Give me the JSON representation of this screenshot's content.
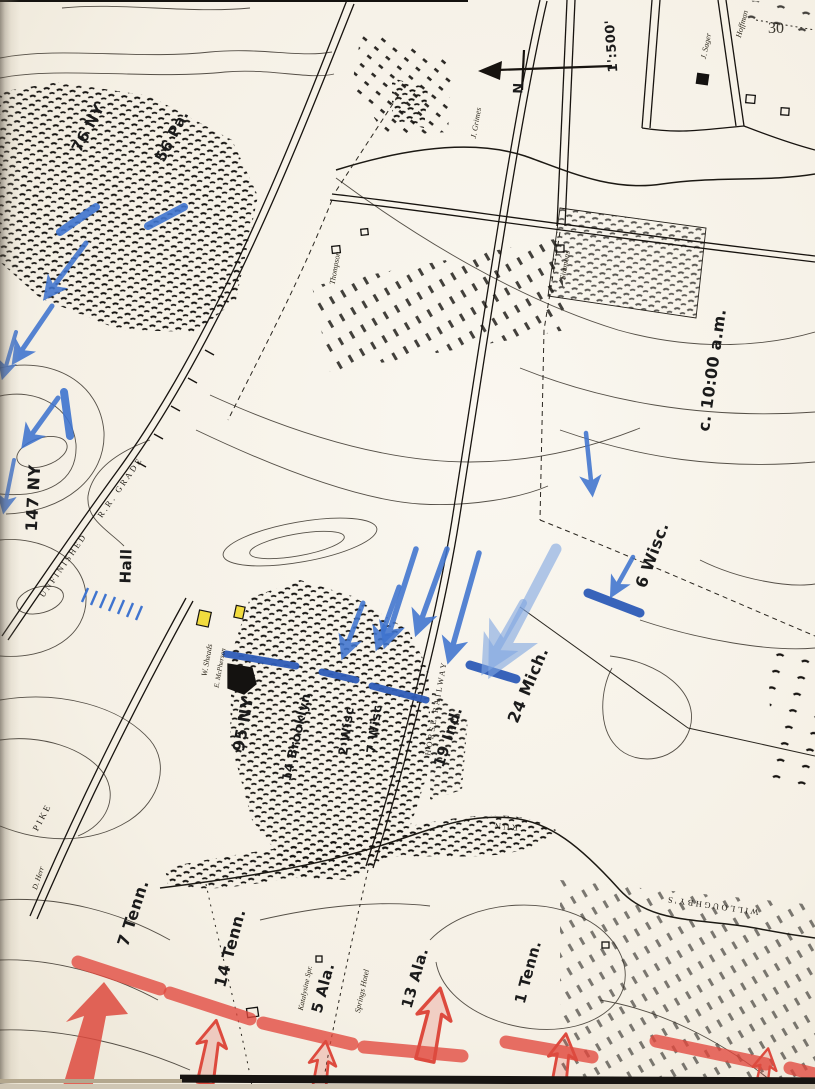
{
  "page": {
    "number": "30"
  },
  "compass": {
    "north": "N",
    "scale": "1':500'"
  },
  "notes": {
    "time": "c. 10:00 a.m."
  },
  "union_units": [
    {
      "label": "76 NY"
    },
    {
      "label": "56 Pa."
    },
    {
      "label": "147 NY"
    },
    {
      "label": "Hall"
    },
    {
      "label": "95 NY"
    },
    {
      "label": "14 Brooklyn"
    },
    {
      "label": "2 Wisc"
    },
    {
      "label": "7 Wisc"
    },
    {
      "label": "19 Ind."
    },
    {
      "label": "24 Mich."
    },
    {
      "label": "6 Wisc."
    }
  ],
  "confederate_units": [
    {
      "label": "7 Tenn."
    },
    {
      "label": "14 Tenn."
    },
    {
      "label": "5 Ala."
    },
    {
      "label": "13 Ala."
    },
    {
      "label": "1 Tenn."
    }
  ],
  "map_features": {
    "unfinished": "UNFINISHED",
    "rr_grade": "R.R. GRADE",
    "horse_railway": "HORSE RAILWAY",
    "pike": "PIKE",
    "willoughbys": "WILLOUGHBY'S",
    "run": "RUN"
  },
  "property_labels": [
    {
      "label": "J. Grimes"
    },
    {
      "label": "Thompson"
    },
    {
      "label": "Simmons"
    },
    {
      "label": "J. Sager"
    },
    {
      "label": "Hoffman"
    },
    {
      "label": "W. Sheads"
    },
    {
      "label": "E. McPherson"
    },
    {
      "label": "Katalysine Spr."
    },
    {
      "label": "Springs Hotel"
    },
    {
      "label": "D. Herr"
    }
  ],
  "colors": {
    "union_blue": "#3f74cf",
    "union_blue_dark": "#2e5cb8",
    "union_blue_light": "#7fa6e2",
    "confederate_red": "#e2483e",
    "highlight_yellow": "#f2dc3e",
    "map_ink": "#17130f",
    "paper": "#f7f3ea"
  }
}
